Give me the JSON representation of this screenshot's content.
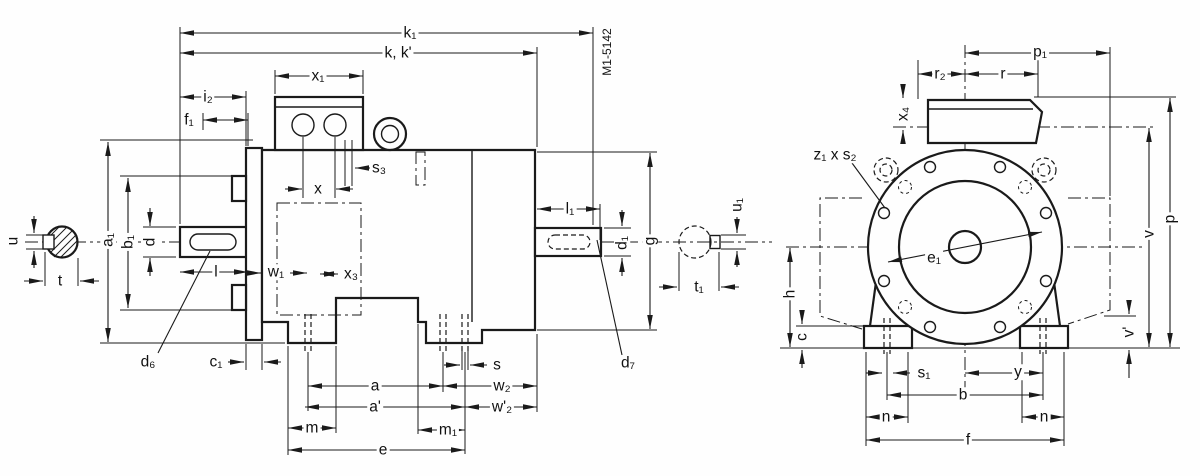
{
  "drawing": {
    "drawing_number": "M1-5142",
    "colors": {
      "line": "#1a1a1a",
      "background": "#fefefe"
    },
    "side_view": {
      "labels": {
        "k1": "k₁",
        "k": "k, k'",
        "x1": "x₁",
        "i2": "i₂",
        "f1": "f₁",
        "s3": "s₃",
        "x": "x",
        "l": "l",
        "w1": "w₁",
        "x3": "x₃",
        "a1": "a₁",
        "b1": "b₁",
        "d": "d",
        "u": "u",
        "t": "t",
        "d6": "d₆",
        "c1": "c₁",
        "s": "s",
        "a": "a",
        "a_prime": "a'",
        "w2": "w₂",
        "w2_prime": "w'₂",
        "m": "m",
        "m1": "m₁",
        "e": "e",
        "l1": "l₁",
        "d1": "d₁",
        "g": "g",
        "u1": "u₁",
        "t1": "t₁",
        "d7": "d₇"
      }
    },
    "front_view": {
      "labels": {
        "p1": "p₁",
        "r2": "r₂",
        "r": "r",
        "x4": "x₄",
        "z1_x_s2": "z₁ x s₂",
        "e1": "e₁",
        "h": "h",
        "c": "c",
        "s1": "s₁",
        "y": "y",
        "b": "b",
        "n_left": "n",
        "n_right": "n",
        "f": "f",
        "v": "v",
        "v_prime": "v'",
        "p": "p"
      }
    }
  }
}
